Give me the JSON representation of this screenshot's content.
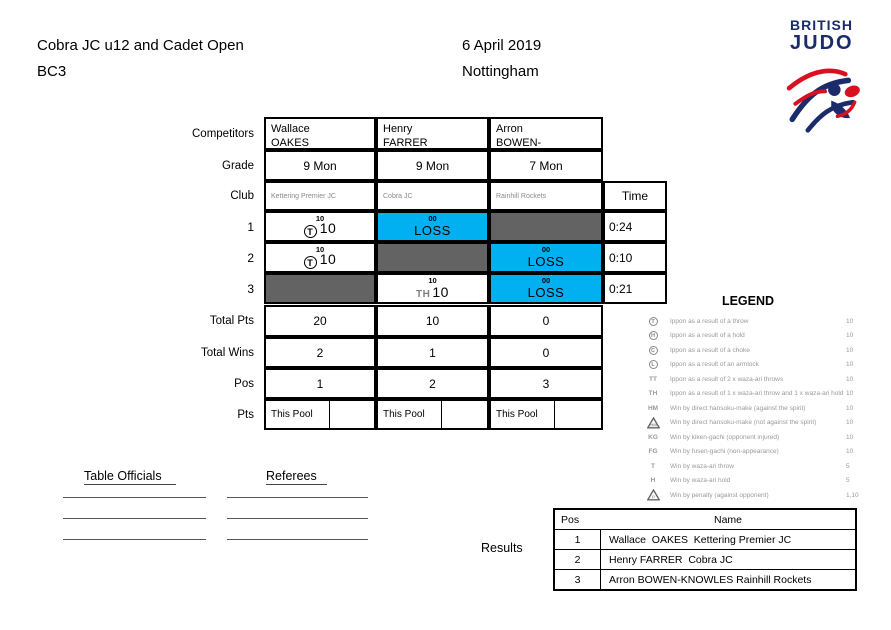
{
  "header": {
    "title_line1": "Cobra JC u12 and Cadet Open",
    "title_line2": "BC3",
    "date": "6 April 2019",
    "location": "Nottingham"
  },
  "logo": {
    "line1": "BRITISH",
    "line2": "JUDO"
  },
  "pool_sheet": {
    "row_labels": {
      "competitors": "Competitors",
      "grade": "Grade",
      "club": "Club",
      "round1": "1",
      "round2": "2",
      "round3": "3",
      "total_pts": "Total Pts",
      "total_wins": "Total Wins",
      "pos": "Pos",
      "pts": "Pts"
    },
    "time_header": "Time",
    "competitors": [
      {
        "first_name": "Wallace",
        "last_name": "OAKES",
        "grade": "9 Mon",
        "club": "Kettering Premier JC",
        "total_pts": "20",
        "total_wins": "2",
        "pos": "1",
        "pts_cell": "This Pool"
      },
      {
        "first_name": "Henry",
        "last_name": "FARRER",
        "grade": "9 Mon",
        "club": "Cobra JC",
        "total_pts": "10",
        "total_wins": "1",
        "pos": "2",
        "pts_cell": "This Pool"
      },
      {
        "first_name": "Arron",
        "last_name": "BOWEN-KNOWLES",
        "grade": "7 Mon",
        "club": "Rainhill Rockets",
        "total_pts": "0",
        "total_wins": "0",
        "pos": "3",
        "pts_cell": "This Pool"
      }
    ],
    "rounds": [
      {
        "label": "1",
        "time": "0:24",
        "cells": [
          {
            "kind": "win",
            "score_top": "10",
            "symbol": "T",
            "score": "10"
          },
          {
            "kind": "loss",
            "score_top": "00",
            "text": "LOSS"
          },
          {
            "kind": "blocked"
          }
        ]
      },
      {
        "label": "2",
        "time": "0:10",
        "cells": [
          {
            "kind": "win",
            "score_top": "10",
            "symbol": "T",
            "score": "10"
          },
          {
            "kind": "blocked"
          },
          {
            "kind": "loss",
            "score_top": "00",
            "text": "LOSS"
          }
        ]
      },
      {
        "label": "3",
        "time": "0:21",
        "cells": [
          {
            "kind": "blocked"
          },
          {
            "kind": "win",
            "score_top": "10",
            "symbol": "TH",
            "score": "10"
          },
          {
            "kind": "loss",
            "score_top": "00",
            "text": "LOSS"
          }
        ]
      }
    ],
    "colors": {
      "loss_bg": "#00b0f0",
      "blocked_bg": "#636363",
      "navy": "#1c2c6b",
      "red": "#d8101f"
    }
  },
  "legend": {
    "title": "LEGEND",
    "items": [
      {
        "style": "circle",
        "symbol": "T",
        "text": "Ippon as a result of a throw",
        "value": "10"
      },
      {
        "style": "circle",
        "symbol": "H",
        "text": "Ippon as a result of a hold",
        "value": "10"
      },
      {
        "style": "circle",
        "symbol": "C",
        "text": "Ippon as a result of a choke",
        "value": "10"
      },
      {
        "style": "circle",
        "symbol": "L",
        "text": "Ippon as a result of an armlock",
        "value": "10"
      },
      {
        "style": "text",
        "symbol": "TT",
        "text": "Ippon as a result of 2 x waza-ari throws",
        "value": "10"
      },
      {
        "style": "text",
        "symbol": "TH",
        "text": "Ippon as a result of 1 x waza-ari throw and 1 x waza-ari hold",
        "value": "10"
      },
      {
        "style": "text",
        "symbol": "HM",
        "text": "Win by direct hansoku-make (against the spirit)",
        "value": "10"
      },
      {
        "style": "triangle",
        "symbol": "HM",
        "text": "Win by direct hansoku-make (not against the spirit)",
        "value": "10"
      },
      {
        "style": "text",
        "symbol": "KG",
        "text": "Win by kiken-gachi (opponent injured)",
        "value": "10"
      },
      {
        "style": "text",
        "symbol": "FG",
        "text": "Win by fusen-gachi (non-appearance)",
        "value": "10"
      },
      {
        "style": "text",
        "symbol": "T",
        "text": "Win by waza-ari throw",
        "value": "5"
      },
      {
        "style": "text",
        "symbol": "H",
        "text": "Win by waza-ari hold",
        "value": "5"
      },
      {
        "style": "triangle",
        "symbol": "P",
        "text": "Win by penalty (against opponent)",
        "value": "1,10"
      }
    ]
  },
  "officials": {
    "table_officials_label": "Table Officials",
    "referees_label": "Referees"
  },
  "results": {
    "label": "Results",
    "col_pos": "Pos",
    "col_name": "Name",
    "rows": [
      {
        "pos": "1",
        "name": "Wallace  OAKES  Kettering Premier JC"
      },
      {
        "pos": "2",
        "name": "Henry FARRER  Cobra JC"
      },
      {
        "pos": "3",
        "name": "Arron BOWEN-KNOWLES Rainhill Rockets"
      }
    ]
  }
}
